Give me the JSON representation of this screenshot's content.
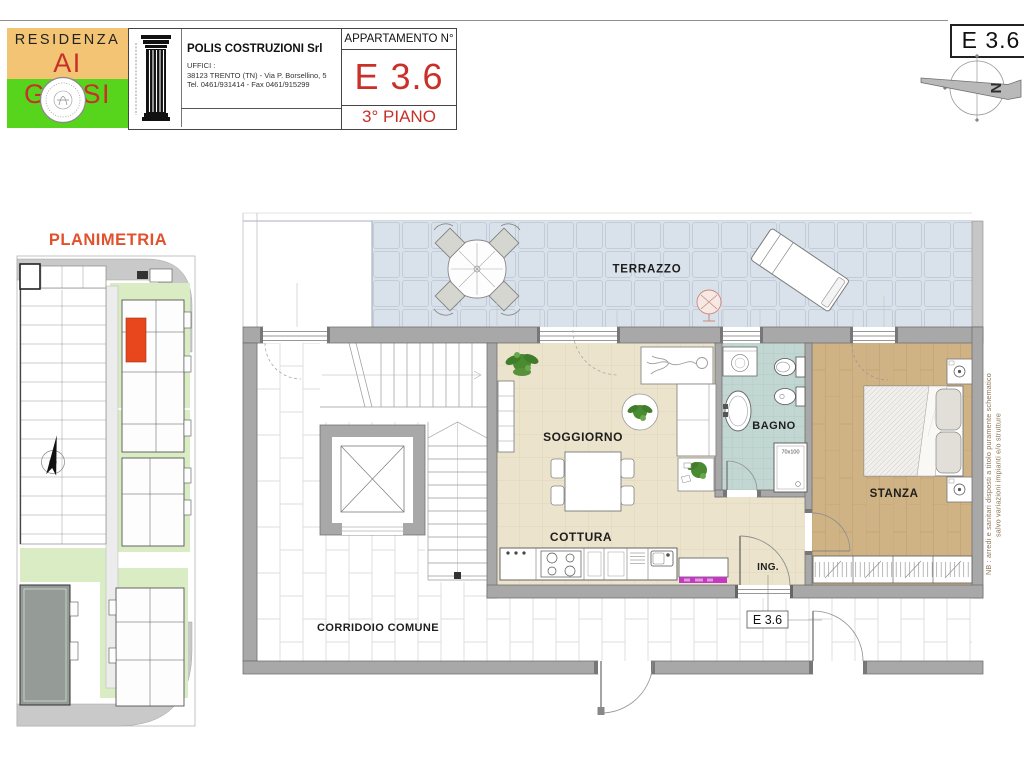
{
  "header": {
    "logo": {
      "line1": "RESIDENZA",
      "line2": "AI GELSI"
    },
    "company": {
      "name": "POLIS COSTRUZIONI Srl",
      "office_label": "UFFICI :",
      "address": "38123 TRENTO (TN) - Via P. Borsellino, 5",
      "phone": "Tel. 0461/931414 - Fax 0461/915299"
    },
    "apartment": {
      "label": "APPARTAMENTO N°",
      "number": "E 3.6",
      "floor": "3° PIANO"
    }
  },
  "corner": {
    "unit_label": "E 3.6",
    "north_letter": "N"
  },
  "site_plan": {
    "title": "PLANIMETRIA"
  },
  "plan": {
    "labels": {
      "terrazzo": "TERRAZZO",
      "soggiorno": "SOGGIORNO",
      "cottura": "COTTURA",
      "bagno": "BAGNO",
      "stanza": "STANZA",
      "ing": "ING.",
      "corridoio": "CORRIDOIO COMUNE",
      "unit_tag": "E 3.6",
      "shower_size": "70x100"
    }
  },
  "note": {
    "line1": "NB : arredi e sanitari disposti a titolo puramente schematico",
    "line2": "salvo variazioni impianti e/o strutture"
  },
  "colors": {
    "accent_red": "#c9302a",
    "logo_orange": "#f2c473",
    "logo_green": "#56d51c",
    "title_orange": "#e0512d",
    "terrace": "#d9e2eb",
    "living": "#ebe3cb",
    "bath": "#c3d7d2",
    "bedroom": "#d0b385",
    "wall": "#a8a8a8",
    "highlight": "#e8471d",
    "magenta": "#c438c4",
    "road": "#c9c9c9",
    "site_green": "#d9ecc4"
  }
}
